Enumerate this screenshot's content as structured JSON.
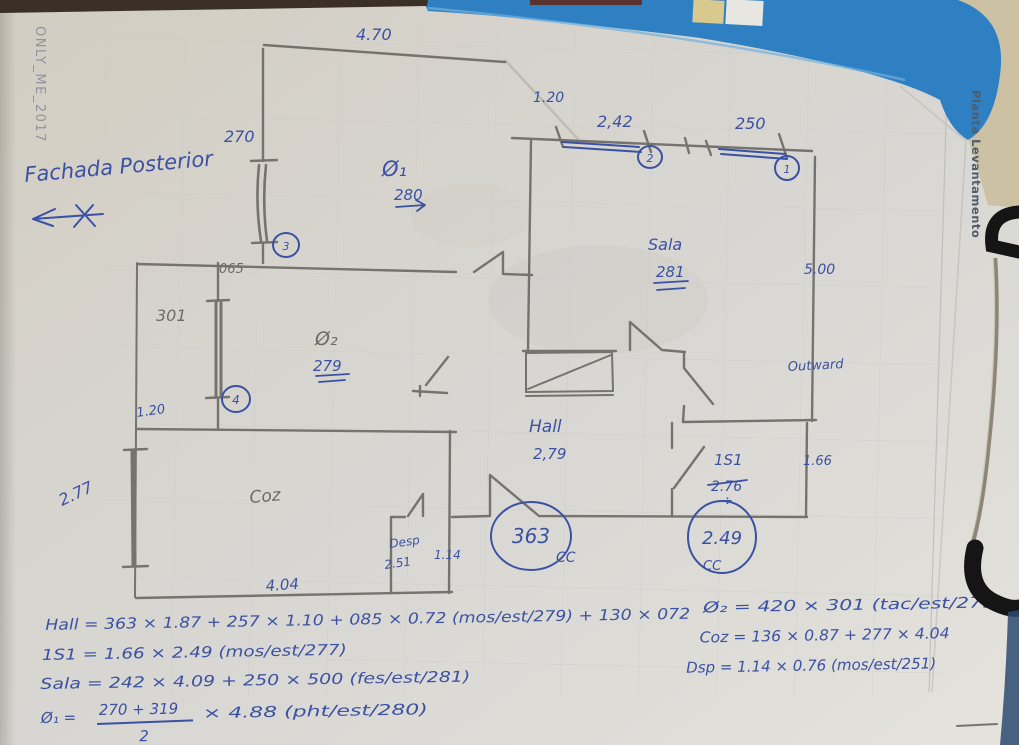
{
  "printed": {
    "watermark": "ONLY_ME_2017",
    "side_label": "Planta Levantamento"
  },
  "notes": {
    "facade": "Fachada Posterior",
    "outward": "Outward"
  },
  "dims": {
    "top_width": "4.70",
    "left_top_window": "270",
    "sala_window_a": "2,42",
    "sala_window_b": "250",
    "sala_offset": "1.20",
    "sala_depth": "5.00",
    "pass_width": "065",
    "q2_window": "301",
    "lightwell_width": "1.20",
    "coz_window": "2.77",
    "coz_length": "4.04",
    "is1_width": "1.66",
    "desp_width": "1.14"
  },
  "rooms": {
    "q1_label": "Ø₁",
    "q1_height": "280",
    "q2_label": "Ø₂",
    "q2_height": "279",
    "sala_label": "Sala",
    "sala_height": "281",
    "hall_label": "Hall",
    "hall_height": "2,79",
    "coz_label": "Coz",
    "desp_label": "Desp",
    "desp_height": "2.51",
    "is1_label": "1S1",
    "is1_height": "2.76",
    "is1_divide": "÷"
  },
  "circled": {
    "c1": "1",
    "c2": "2",
    "c3": "3",
    "c4": "4",
    "hall_width": "363",
    "hall_cc": "CC",
    "is1_depth": "2.49",
    "is1_cc": "CC"
  },
  "formulas": {
    "hall": "Hall = 363 × 1.87 + 257 × 1.10 + 085 × 0.72 (mos/est/279) + 130 × 072",
    "is1": "1S1 = 1.66 × 2.49 (mos/est/277)",
    "sala": "Sala = 242 × 4.09 + 250 × 500 (fes/est/281)",
    "q1_lead": "Ø₁ =",
    "q1_num": "270 + 319",
    "q1_den": "2",
    "q1_rest": "× 4.88 (pht/est/280)",
    "q2": "Ø₂ = 420 × 301 (tac/est/279)",
    "coz": "Coz = 136 × 0.87 + 277 × 4.04",
    "desp": "Dsp = 1.14 × 0.76 (mos/est/251)"
  }
}
